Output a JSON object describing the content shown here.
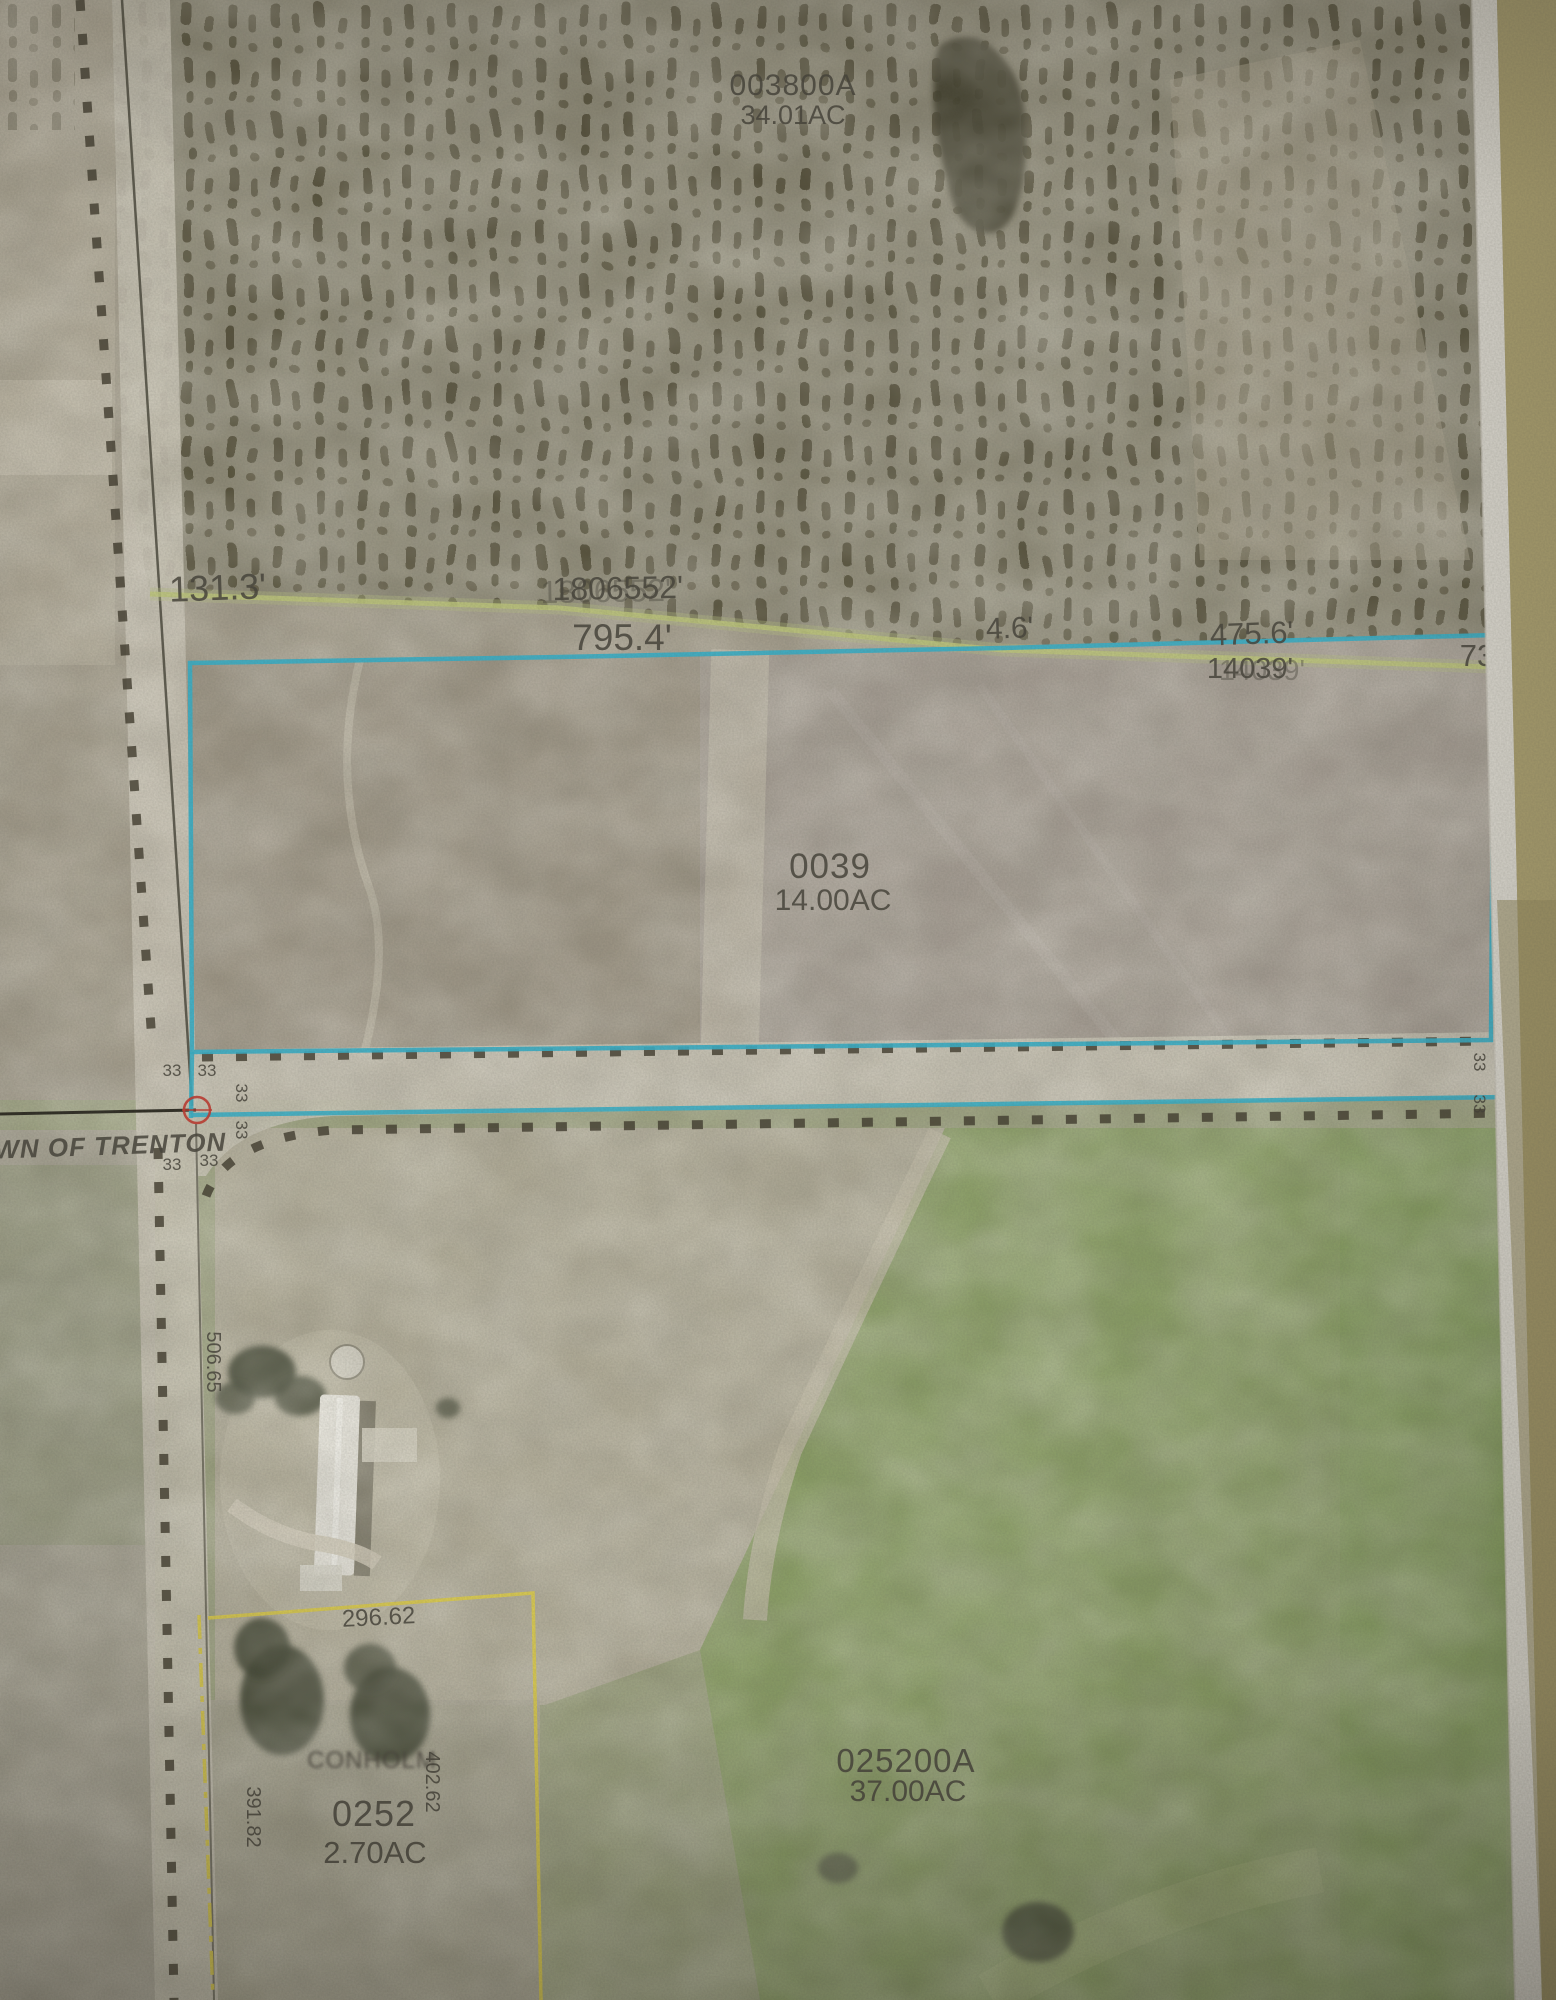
{
  "map": {
    "town_label": "OWN OF TRENTON",
    "parcels": {
      "p003800A": {
        "number": "003800A",
        "acreage": "34.01AC"
      },
      "p0039": {
        "number": "0039",
        "acreage": "14.00AC"
      },
      "p025200A": {
        "number": "025200A",
        "acreage": "37.00AC"
      },
      "p0252": {
        "number": "0252",
        "acreage": "2.70AC",
        "owner": "CONHOLM"
      }
    },
    "dimensions": {
      "d131_3": "131.3'",
      "d1806552": "1806552'",
      "d795_4": "795.4'",
      "d4_6": "4.6'",
      "d475_6": "475.6'",
      "d14039": "14039'",
      "d73": "73",
      "d296_62": "296.62",
      "d391_82": "391.82",
      "d402_62": "402.62",
      "d506_65": "506.65"
    },
    "section_marker": "33",
    "colors": {
      "parcel_boundary_cyan": "#38aec5",
      "parcel_boundary_yellow": "#d9c94e",
      "adjacent_parcel_line_green": "#bdc57b",
      "town_label_red": "#bf3a30"
    }
  }
}
